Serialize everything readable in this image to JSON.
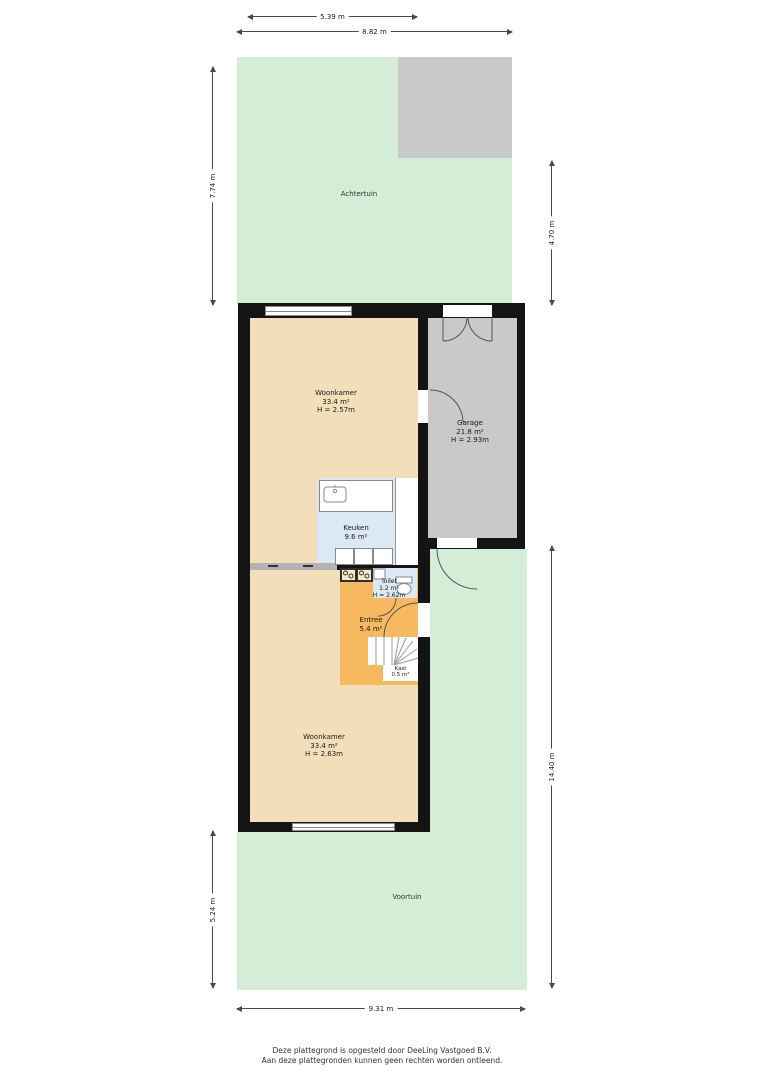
{
  "title": "Plattegrond begane grond met tuin",
  "dims": {
    "top_inner": "5.39 m",
    "top_outer": "8.82 m",
    "left_back": "7.74 m",
    "right_back": "4.70 m",
    "left_front": "5.24 m",
    "right_front": "14.40 m",
    "bottom": "9.31 m"
  },
  "gardens": {
    "back": "Achtertuin",
    "front": "Voortuin"
  },
  "rooms": {
    "living_upper": {
      "name": "Woonkamer",
      "area": "33.4 m²",
      "height": "H = 2.57m"
    },
    "garage": {
      "name": "Garage",
      "area": "21.8 m²",
      "height": "H = 2.93m"
    },
    "kitchen": {
      "name": "Keuken",
      "area": "9.6 m²"
    },
    "toilet": {
      "name": "Toilet",
      "area": "1.2 m²",
      "height": "H = 2.62m"
    },
    "entry": {
      "name": "Entree",
      "area": "5.4 m²"
    },
    "closet": {
      "name": "Kast",
      "area": "0.5 m²"
    },
    "living_lower": {
      "name": "Woonkamer",
      "area": "33.4 m²",
      "height": "H = 2.63m"
    }
  },
  "footer": [
    "Deze plattegrond is opgesteld door DeeLing Vastgoed B.V.",
    "Aan deze plattegronden kunnen geen rechten worden ontleend."
  ],
  "colors": {
    "garden_green": "#d3edd6",
    "garage_gray": "#c9c9c9",
    "floor_tan": "#f2dfba",
    "wet_room_blue": "#dce8f3",
    "entry_orange": "#f6b95f",
    "wall_black": "#141414"
  }
}
